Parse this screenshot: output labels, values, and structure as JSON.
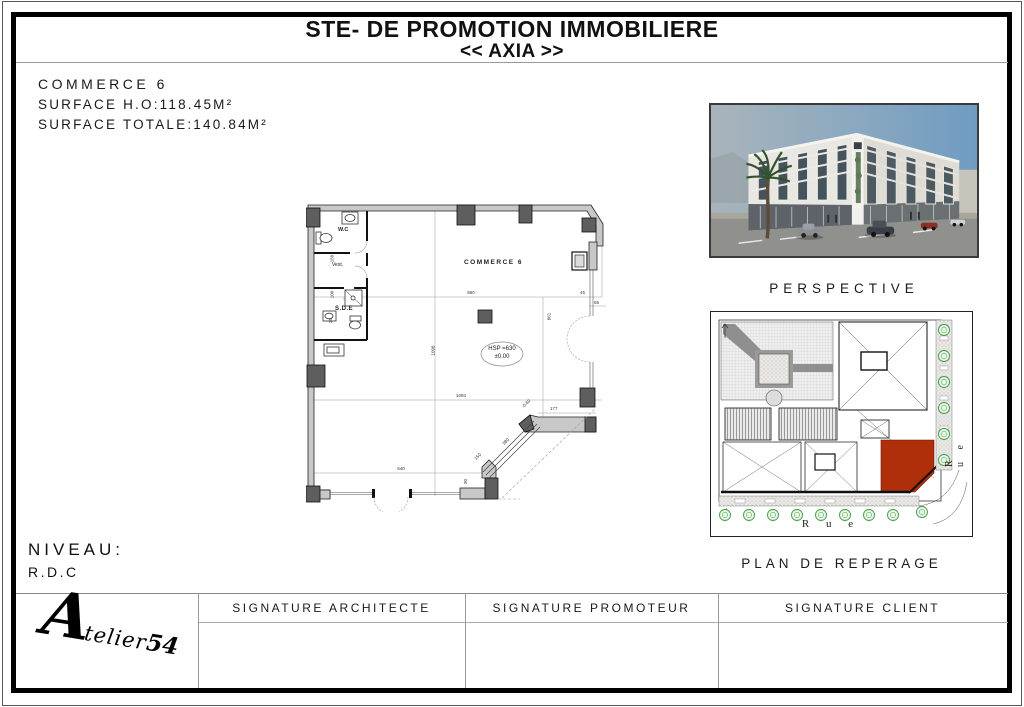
{
  "header": {
    "title_line1": "STE- DE PROMOTION IMMOBILIERE",
    "title_line2": "<< AXIA >>"
  },
  "info": {
    "lot_label": "COMMERCE 6",
    "surface_ho": "SURFACE H.O:118.45M²",
    "surface_totale": "SURFACE TOTALE:140.84M²"
  },
  "level": {
    "label": "NIVEAU:",
    "value": "R.D.C"
  },
  "perspective": {
    "caption": "PERSPECTIVE"
  },
  "site_plan": {
    "caption": "PLAN DE REPERAGE",
    "street_bottom": "R u e",
    "street_right": "R u e",
    "highlight_color": "#b02f0b"
  },
  "floor_plan": {
    "room_label": "COMMERCE 6",
    "wc": "W.C",
    "vest": "Vest.",
    "sde": "S.D.E",
    "hsp_line1": "HSP =630",
    "hsp_line2": "±0.00",
    "dims": {
      "w860": "860",
      "w1094": "1094",
      "w640": "640",
      "h1098": "1098",
      "h861": "861",
      "r45": "45",
      "r65": "65",
      "s380": "380",
      "s150": "150",
      "s90": "90",
      "j177": "177",
      "lvl": "-0.60",
      "l150": "150",
      "l100": "100",
      "l25": "25"
    }
  },
  "signatures": {
    "architect": "SIGNATURE ARCHITECTE",
    "promoter": "SIGNATURE PROMOTEUR",
    "client": "SIGNATURE CLIENT"
  },
  "logo": {
    "initial": "A",
    "rest": "telier",
    "suffix": "54"
  }
}
